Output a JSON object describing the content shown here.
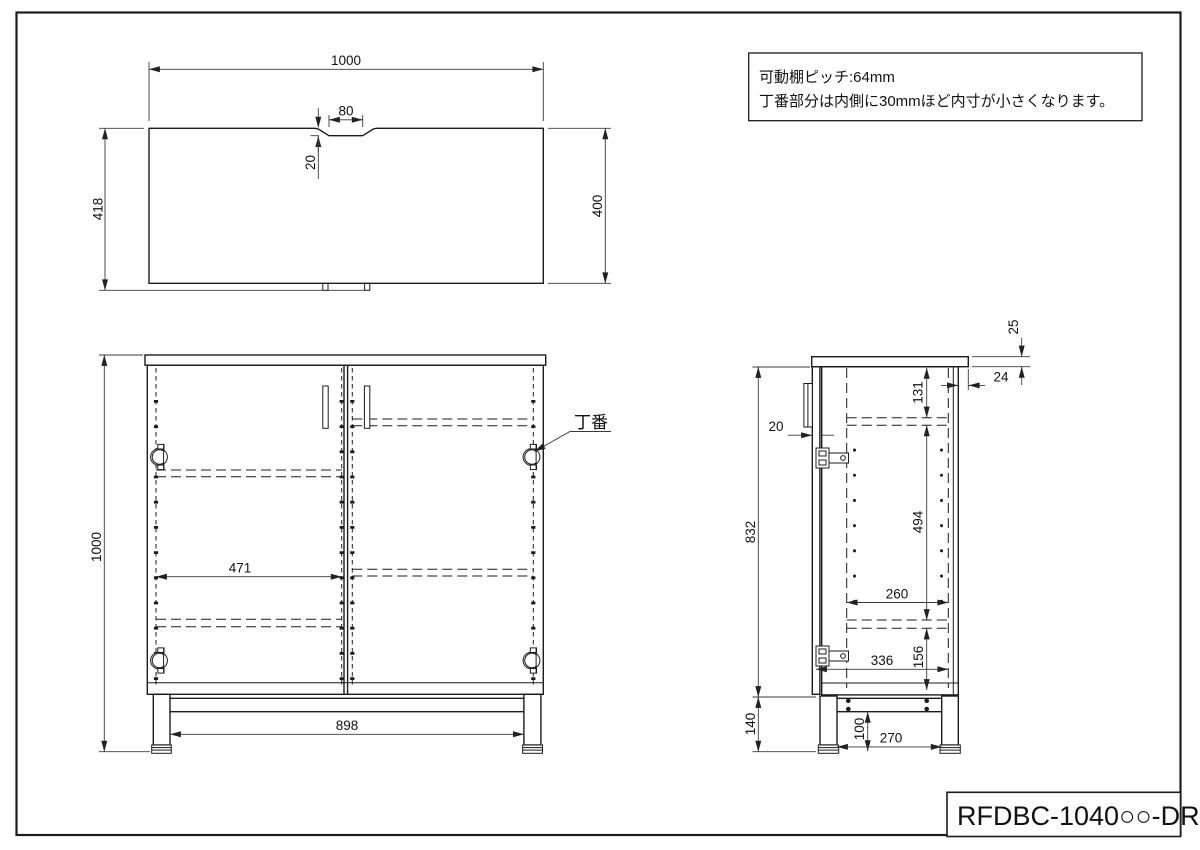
{
  "note": {
    "line1": "可動棚ピッチ:64mm",
    "line2": "丁番部分は内側に30mmほど内寸が小さくなります。"
  },
  "title_block": {
    "model": "RFDBC-1040○○-DR"
  },
  "top_view": {
    "dim_width": "1000",
    "dim_depth_total": "418",
    "dim_depth_top": "400",
    "dim_notch_width": "80",
    "dim_notch_depth": "20"
  },
  "front_view": {
    "dim_height": "1000",
    "dim_inner_width": "471",
    "dim_leg_span": "898",
    "hinge_label": "丁番"
  },
  "side_view": {
    "dim_body_height": "832",
    "dim_base_height": "140",
    "dim_door_thickness": "20",
    "dim_top_thickness": "25",
    "dim_top_back_overhang": "24",
    "dim_top_clearance": "131",
    "dim_inner_height": "494",
    "dim_inner_depth": "260",
    "dim_bottom_clearance": "156",
    "dim_inner_total_depth": "336",
    "dim_leg_height": "100",
    "dim_leg_depth_span": "270"
  },
  "colors": {
    "line": "#1c1c1c",
    "background": "#ffffff"
  }
}
